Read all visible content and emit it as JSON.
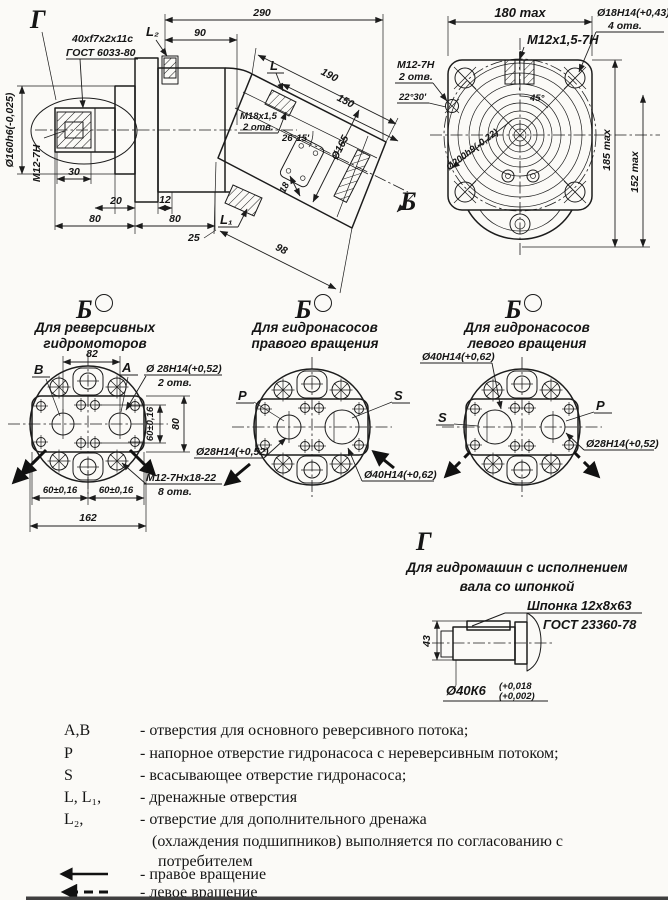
{
  "side_view": {
    "g_label": "Г",
    "spline_spec": "40xf7x2x11c",
    "spline_gost": "ГОСТ 6033-80",
    "l2": "L₂",
    "dim_90": "90",
    "dim_290": "290",
    "l": "L",
    "dim_190": "190",
    "dim_150": "150",
    "m18": "M18x1,5",
    "m18_holes": "2 отв.",
    "angle_26": "26°15'",
    "dia_165": "Ø165",
    "dim_18": "18",
    "dim_98": "98",
    "l1": "L₁",
    "dim_25": "25",
    "b_label": "Б",
    "shaft_dia": "Ø160h6(-0,025)",
    "m12": "M12-7H",
    "dim_30": "30",
    "dim_20": "20",
    "dim_12": "12",
    "dim_80a": "80",
    "dim_80b": "80"
  },
  "front_view": {
    "dim_180": "180 max",
    "thread_top": "M12x1,5-7H",
    "dia_18": "Ø18H14(+0,43)",
    "dia_18_holes": "4 отв.",
    "thread_side": "M12-7H",
    "thread_side_holes": "2 отв.",
    "angle_2230": "22°30'",
    "angle_45": "45°",
    "dia_200": "Ø200h9(-0,22)",
    "dim_185": "185 max",
    "dim_152": "152 max"
  },
  "views": {
    "b1": {
      "label": "Б",
      "caption1": "Для реверсивных",
      "caption2": "гидромоторов",
      "b": "B",
      "a": "A",
      "dim_82": "82",
      "dia_28": "Ø 28H14(+0,52)",
      "dia_28_holes": "2 отв.",
      "dim_60v": "60±0,16",
      "dim_80": "80",
      "thread": "M12-7Hх18-22",
      "thread_holes": "8 отв.",
      "dim_60a": "60±0,16",
      "dim_60b": "60±0,16",
      "dim_162": "162"
    },
    "b2": {
      "label": "Б",
      "caption1": "Для гидронасосов",
      "caption2": "правого вращения",
      "p": "P",
      "s": "S",
      "dia_28": "Ø28H14(+0,52)",
      "dia_40": "Ø40H14(+0,62)"
    },
    "b3": {
      "label": "Б",
      "caption1": "Для гидронасосов",
      "caption2": "левого вращения",
      "s": "S",
      "p": "P",
      "dia_40": "Ø40H14(+0,62)",
      "dia_28": "Ø28H14(+0,52)"
    }
  },
  "section_g": {
    "label": "Г",
    "caption1": "Для гидромашин с исполнением",
    "caption2": "вала со шпонкой",
    "key_spec": "Шпонка 12х8х63",
    "key_gost": "ГОСТ 23360-78",
    "dim_43": "43",
    "shaft_dia": "Ø40К6",
    "tol_upper": "(+0,018",
    "tol_lower": "(+0,002)"
  },
  "legend": {
    "rows": [
      {
        "sym": "А,В",
        "text": "- отверстия для основного реверсивного потока;"
      },
      {
        "sym": "Р",
        "text": "- напорное отверстие гидронасоса с нереверсивным потоком;"
      },
      {
        "sym": "S",
        "text": "- всасывающее  отверстие гидронасоса;"
      },
      {
        "sym": "L, L₁,",
        "text": "- дренажные отверстия"
      },
      {
        "sym": "L₂,",
        "text": "- отверстие для дополнительного дренажа"
      }
    ],
    "cont1": "(охлаждения подшипников) выполняется по согласованию с",
    "cont2": "потребителем",
    "right_rot": "- правое вращение",
    "left_rot": "- левое вращение"
  }
}
